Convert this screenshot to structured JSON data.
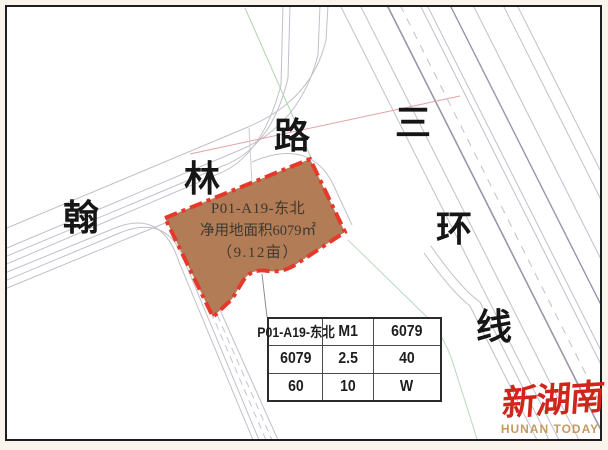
{
  "parcel": {
    "line1": "P01-A19-东北",
    "line2": "净用地面积6079㎡",
    "line3": "（9.12亩）",
    "fill_color": "#b17c56",
    "border_color": "#e6382b"
  },
  "roads": {
    "hanlin": {
      "name": "翰林路",
      "chars": [
        "翰",
        "林",
        "路"
      ]
    },
    "sanhuan": {
      "name": "三环线",
      "chars": [
        "三",
        "环",
        "线"
      ]
    }
  },
  "table": {
    "rows": [
      [
        "P01-A19-东北",
        "M1",
        "6079"
      ],
      [
        "6079",
        "2.5",
        "40"
      ],
      [
        "60",
        "10",
        "W"
      ]
    ]
  },
  "watermark": {
    "cn": "新湖南",
    "en": "HUNAN TODAY",
    "cn_color": "#d0251b",
    "en_color": "#c59a62"
  },
  "colors": {
    "road_line": "#c2bfca",
    "road_line_dark": "#9a96a8",
    "frame": "#1f1f1f",
    "margin": "#faf5ec"
  }
}
